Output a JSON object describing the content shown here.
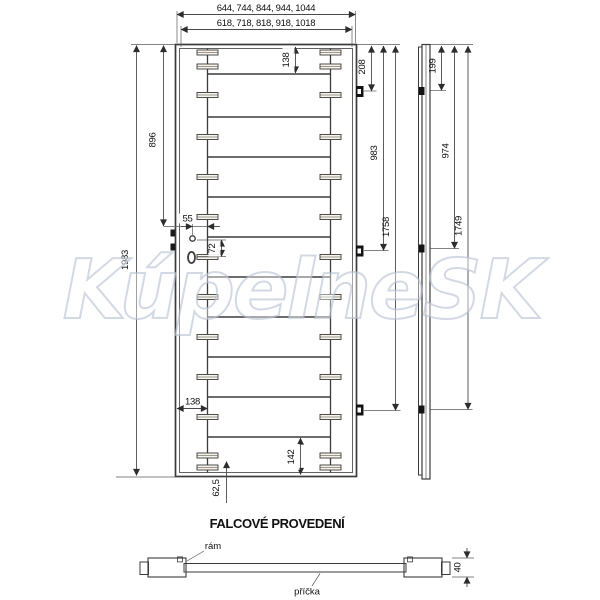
{
  "watermark": {
    "text": "KúpelneSK"
  },
  "front_view": {
    "width_series_outer": "644, 744, 844, 944, 1044",
    "width_series_inner": "618, 718, 818, 918, 1018",
    "total_height": "1983",
    "handle_center_from_top": "896",
    "top_rail_height": "138",
    "stile_width": "138",
    "bottom_rail_height": "142",
    "lock_edge_offset": "55",
    "lock_hole_spacing": "72",
    "bottom_dowel_offset": "62,5",
    "hinge_top_from_top": "208",
    "hinge_middle_from_top": "983",
    "hinge_bottom_from_top": "1758"
  },
  "side_view": {
    "hinge_top_from_top": "199",
    "hinge_middle_from_top": "974",
    "hinge_bottom_from_top": "1749"
  },
  "section_view": {
    "title": "FALCOVÉ PROVEDENÍ",
    "frame_label": "rám",
    "crossbar_label": "příčka",
    "door_thickness": "40"
  },
  "colors": {
    "door_fill": "#e9e0cf",
    "tenon_fill": "#f8f4ea",
    "outline": "#3b3b3b",
    "watermark_stroke": "#b6c0d0"
  }
}
